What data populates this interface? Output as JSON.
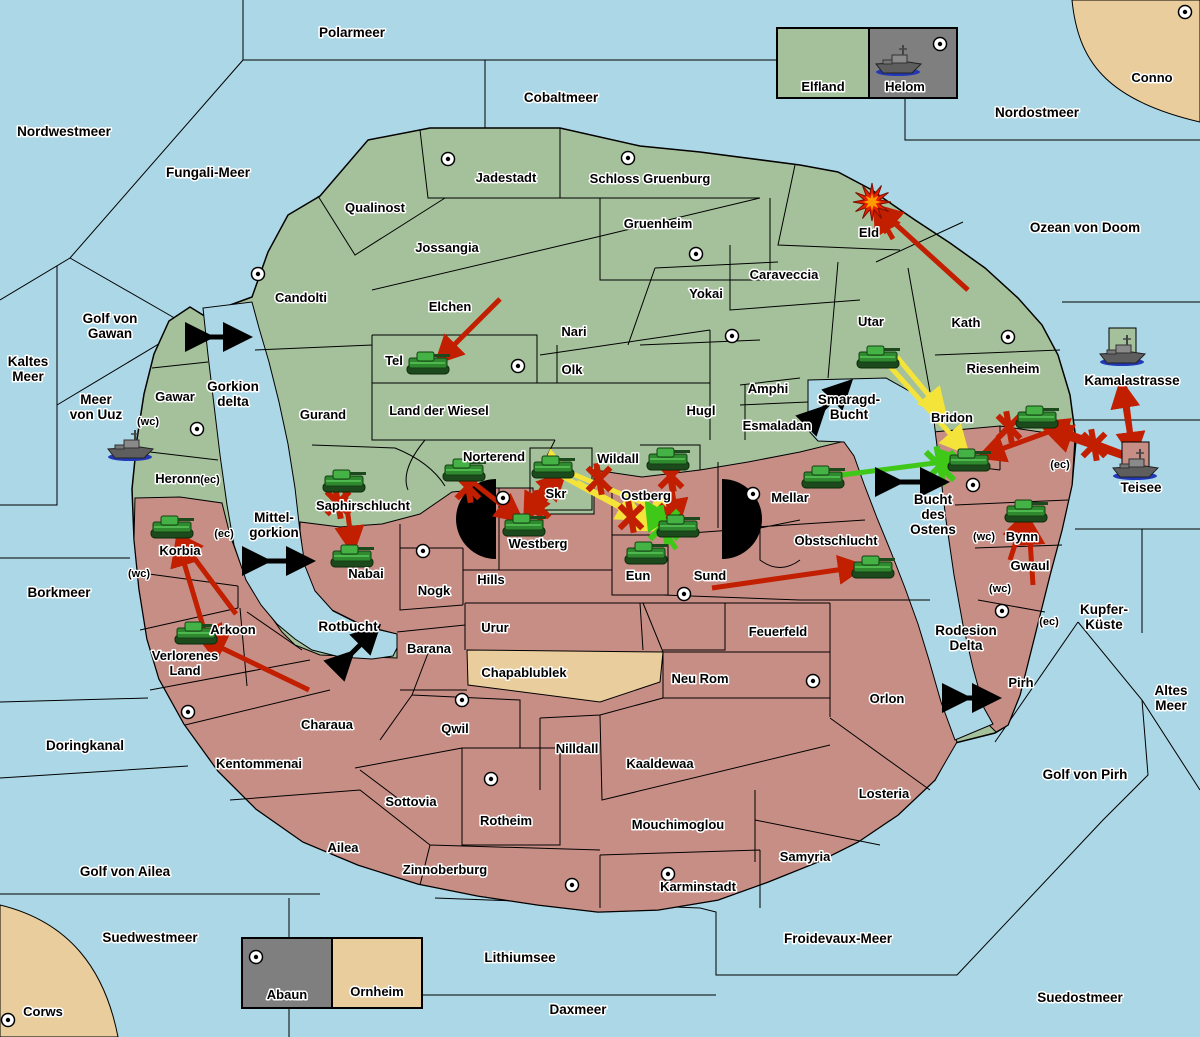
{
  "colors": {
    "sea": "#ABD7E6",
    "land_green": "#A5C19B",
    "land_red": "#C78E85",
    "land_tan": "#EACD9C",
    "legend_gray": "#7F7F7F",
    "border": "#000000",
    "arrow_red": "#C21E00",
    "arrow_yellow": "#F4E43A",
    "arrow_green": "#3FC818",
    "passage_black": "#000000",
    "halo": "#FFFFFF"
  },
  "legend_top": {
    "left": "Elfland",
    "right": "Helom"
  },
  "legend_bottom": {
    "left": "Abaun",
    "right": "Ornheim"
  },
  "sea_labels": [
    {
      "x": 352,
      "y": 37,
      "lines": [
        "Polarmeer"
      ]
    },
    {
      "x": 561,
      "y": 102,
      "lines": [
        "Cobaltmeer"
      ]
    },
    {
      "x": 1037,
      "y": 117,
      "lines": [
        "Nordostmeer"
      ]
    },
    {
      "x": 1085,
      "y": 232,
      "lines": [
        "Ozean von Doom"
      ]
    },
    {
      "x": 64,
      "y": 136,
      "lines": [
        "Nordwestmeer"
      ]
    },
    {
      "x": 208,
      "y": 177,
      "lines": [
        "Fungali-Meer"
      ]
    },
    {
      "x": 28,
      "y": 366,
      "lines": [
        "Kaltes",
        "Meer"
      ]
    },
    {
      "x": 110,
      "y": 323,
      "lines": [
        "Golf von",
        "Gawan"
      ]
    },
    {
      "x": 96,
      "y": 404,
      "lines": [
        "Meer",
        "von Uuz"
      ]
    },
    {
      "x": 233,
      "y": 391,
      "lines": [
        "Gorkion",
        "delta"
      ]
    },
    {
      "x": 274,
      "y": 522,
      "lines": [
        "Mittel-",
        "gorkion"
      ]
    },
    {
      "x": 59,
      "y": 597,
      "lines": [
        "Borkmeer"
      ]
    },
    {
      "x": 348,
      "y": 631,
      "lines": [
        "Rotbucht"
      ]
    },
    {
      "x": 849,
      "y": 404,
      "lines": [
        "Smaragd-",
        "Bucht"
      ]
    },
    {
      "x": 933,
      "y": 504,
      "lines": [
        "Bucht",
        "des",
        "Ostens"
      ]
    },
    {
      "x": 1132,
      "y": 385,
      "lines": [
        "Kamalastrasse"
      ]
    },
    {
      "x": 1141,
      "y": 492,
      "lines": [
        "Teisee"
      ]
    },
    {
      "x": 1104,
      "y": 614,
      "lines": [
        "Kupfer-",
        "Küste"
      ]
    },
    {
      "x": 1171,
      "y": 695,
      "lines": [
        "Altes",
        "Meer"
      ]
    },
    {
      "x": 1085,
      "y": 779,
      "lines": [
        "Golf von Pirh"
      ]
    },
    {
      "x": 966,
      "y": 635,
      "lines": [
        "Rodesion",
        "Delta"
      ]
    },
    {
      "x": 85,
      "y": 750,
      "lines": [
        "Doringkanal"
      ]
    },
    {
      "x": 125,
      "y": 876,
      "lines": [
        "Golf von Ailea"
      ]
    },
    {
      "x": 150,
      "y": 942,
      "lines": [
        "Suedwestmeer"
      ]
    },
    {
      "x": 520,
      "y": 962,
      "lines": [
        "Lithiumsee"
      ]
    },
    {
      "x": 578,
      "y": 1014,
      "lines": [
        "Daxmeer"
      ]
    },
    {
      "x": 838,
      "y": 943,
      "lines": [
        "Froidevaux-Meer"
      ]
    },
    {
      "x": 1080,
      "y": 1002,
      "lines": [
        "Suedostmeer"
      ]
    }
  ],
  "region_labels": [
    {
      "x": 506,
      "y": 182,
      "lines": [
        "Jadestadt"
      ]
    },
    {
      "x": 650,
      "y": 183,
      "lines": [
        "Schloss Gruenburg"
      ]
    },
    {
      "x": 375,
      "y": 212,
      "lines": [
        "Qualinost"
      ]
    },
    {
      "x": 447,
      "y": 252,
      "lines": [
        "Jossangia"
      ]
    },
    {
      "x": 658,
      "y": 228,
      "lines": [
        "Gruenheim"
      ]
    },
    {
      "x": 784,
      "y": 279,
      "lines": [
        "Caraveccia"
      ]
    },
    {
      "x": 706,
      "y": 298,
      "lines": [
        "Yokai"
      ]
    },
    {
      "x": 301,
      "y": 302,
      "lines": [
        "Candolti"
      ]
    },
    {
      "x": 450,
      "y": 311,
      "lines": [
        "Elchen"
      ]
    },
    {
      "x": 574,
      "y": 336,
      "lines": [
        "Nari"
      ]
    },
    {
      "x": 572,
      "y": 374,
      "lines": [
        "Olk"
      ]
    },
    {
      "x": 394,
      "y": 365,
      "lines": [
        "Tel"
      ]
    },
    {
      "x": 323,
      "y": 419,
      "lines": [
        "Gurand"
      ]
    },
    {
      "x": 439,
      "y": 415,
      "lines": [
        "Land der Wiesel"
      ]
    },
    {
      "x": 701,
      "y": 415,
      "lines": [
        "Hugl"
      ]
    },
    {
      "x": 768,
      "y": 393,
      "lines": [
        "Amphi"
      ]
    },
    {
      "x": 777,
      "y": 430,
      "lines": [
        "Esmaladan"
      ]
    },
    {
      "x": 869,
      "y": 237,
      "lines": [
        "Eld"
      ]
    },
    {
      "x": 871,
      "y": 326,
      "lines": [
        "Utar"
      ]
    },
    {
      "x": 966,
      "y": 327,
      "lines": [
        "Kath"
      ]
    },
    {
      "x": 1003,
      "y": 373,
      "lines": [
        "Riesenheim"
      ]
    },
    {
      "x": 494,
      "y": 461,
      "lines": [
        "Norterend"
      ]
    },
    {
      "x": 618,
      "y": 463,
      "lines": [
        "Wildall"
      ]
    },
    {
      "x": 556,
      "y": 498,
      "lines": [
        "Skr"
      ]
    },
    {
      "x": 646,
      "y": 500,
      "lines": [
        "Ostberg"
      ]
    },
    {
      "x": 175,
      "y": 401,
      "lines": [
        "Gawar"
      ]
    },
    {
      "x": 178,
      "y": 483,
      "lines": [
        "Heronn"
      ]
    },
    {
      "x": 363,
      "y": 510,
      "lines": [
        "Saphirschlucht"
      ]
    },
    {
      "x": 180,
      "y": 555,
      "lines": [
        "Korbia"
      ]
    },
    {
      "x": 233,
      "y": 634,
      "lines": [
        "Arkoon"
      ]
    },
    {
      "x": 185,
      "y": 660,
      "lines": [
        "Verlorenes",
        "Land"
      ]
    },
    {
      "x": 327,
      "y": 729,
      "lines": [
        "Charaua"
      ]
    },
    {
      "x": 259,
      "y": 768,
      "lines": [
        "Kentommenai"
      ]
    },
    {
      "x": 343,
      "y": 852,
      "lines": [
        "Ailea"
      ]
    },
    {
      "x": 445,
      "y": 874,
      "lines": [
        "Zinnoberburg"
      ]
    },
    {
      "x": 411,
      "y": 806,
      "lines": [
        "Sottovia"
      ]
    },
    {
      "x": 506,
      "y": 825,
      "lines": [
        "Rotheim"
      ]
    },
    {
      "x": 455,
      "y": 733,
      "lines": [
        "Qwil"
      ]
    },
    {
      "x": 366,
      "y": 578,
      "lines": [
        "Nabai"
      ]
    },
    {
      "x": 434,
      "y": 595,
      "lines": [
        "Nogk"
      ]
    },
    {
      "x": 491,
      "y": 584,
      "lines": [
        "Hills"
      ]
    },
    {
      "x": 538,
      "y": 548,
      "lines": [
        "Westberg"
      ]
    },
    {
      "x": 638,
      "y": 580,
      "lines": [
        "Eun"
      ]
    },
    {
      "x": 710,
      "y": 580,
      "lines": [
        "Sund"
      ]
    },
    {
      "x": 790,
      "y": 502,
      "lines": [
        "Mellar"
      ]
    },
    {
      "x": 836,
      "y": 545,
      "lines": [
        "Obstschlucht"
      ]
    },
    {
      "x": 495,
      "y": 632,
      "lines": [
        "Urur"
      ]
    },
    {
      "x": 429,
      "y": 653,
      "lines": [
        "Barana"
      ]
    },
    {
      "x": 524,
      "y": 677,
      "lines": [
        "Chapablublek"
      ]
    },
    {
      "x": 700,
      "y": 683,
      "lines": [
        "Neu Rom"
      ]
    },
    {
      "x": 778,
      "y": 636,
      "lines": [
        "Feuerfeld"
      ]
    },
    {
      "x": 577,
      "y": 753,
      "lines": [
        "Nilldall"
      ]
    },
    {
      "x": 660,
      "y": 768,
      "lines": [
        "Kaaldewaa"
      ]
    },
    {
      "x": 678,
      "y": 829,
      "lines": [
        "Mouchimoglou"
      ]
    },
    {
      "x": 887,
      "y": 703,
      "lines": [
        "Orlon"
      ]
    },
    {
      "x": 884,
      "y": 798,
      "lines": [
        "Losteria"
      ]
    },
    {
      "x": 805,
      "y": 861,
      "lines": [
        "Samyria"
      ]
    },
    {
      "x": 698,
      "y": 891,
      "lines": [
        "Karminstadt"
      ]
    },
    {
      "x": 952,
      "y": 422,
      "lines": [
        "Bridon"
      ]
    },
    {
      "x": 1022,
      "y": 541,
      "lines": [
        "Bynn"
      ]
    },
    {
      "x": 1030,
      "y": 570,
      "lines": [
        "Gwaul"
      ]
    },
    {
      "x": 1021,
      "y": 687,
      "lines": [
        "Pirh"
      ]
    },
    {
      "x": 1152,
      "y": 82,
      "lines": [
        "Conno"
      ]
    },
    {
      "x": 43,
      "y": 1016,
      "lines": [
        "Corws"
      ]
    }
  ],
  "status_labels": [
    {
      "x": 148,
      "y": 425,
      "t": "(wc)"
    },
    {
      "x": 210,
      "y": 483,
      "t": "(ec)"
    },
    {
      "x": 224,
      "y": 537,
      "t": "(ec)"
    },
    {
      "x": 139,
      "y": 577,
      "t": "(wc)"
    },
    {
      "x": 1060,
      "y": 468,
      "t": "(ec)"
    },
    {
      "x": 984,
      "y": 540,
      "t": "(wc)"
    },
    {
      "x": 1000,
      "y": 592,
      "t": "(wc)"
    },
    {
      "x": 1049,
      "y": 625,
      "t": "(ec)"
    }
  ],
  "cities": [
    [
      448,
      159
    ],
    [
      628,
      158
    ],
    [
      696,
      254
    ],
    [
      732,
      336
    ],
    [
      258,
      274
    ],
    [
      518,
      366
    ],
    [
      1008,
      337
    ],
    [
      197,
      429
    ],
    [
      503,
      498
    ],
    [
      423,
      551
    ],
    [
      753,
      494
    ],
    [
      684,
      594
    ],
    [
      973,
      485
    ],
    [
      188,
      712
    ],
    [
      462,
      700
    ],
    [
      491,
      779
    ],
    [
      572,
      885
    ],
    [
      813,
      681
    ],
    [
      668,
      874
    ],
    [
      1002,
      611
    ],
    [
      1185,
      12
    ],
    [
      8,
      1020
    ],
    [
      940,
      44
    ],
    [
      256,
      957
    ]
  ],
  "tanks": [
    [
      428,
      363
    ],
    [
      878,
      357
    ],
    [
      1037,
      417
    ],
    [
      969,
      460
    ],
    [
      823,
      477
    ],
    [
      873,
      567
    ],
    [
      1026,
      511
    ],
    [
      464,
      470
    ],
    [
      553,
      467
    ],
    [
      668,
      459
    ],
    [
      524,
      525
    ],
    [
      646,
      553
    ],
    [
      678,
      526
    ],
    [
      344,
      481
    ],
    [
      352,
      556
    ],
    [
      172,
      527
    ],
    [
      196,
      633
    ]
  ],
  "ships": [
    {
      "x": 130,
      "y": 447,
      "box": ""
    },
    {
      "x": 898,
      "y": 62,
      "box": ""
    },
    {
      "x": 1122,
      "y": 352,
      "box": "#A5C19B"
    },
    {
      "x": 1135,
      "y": 466,
      "box": "#C78E85"
    }
  ],
  "explosions": [
    [
      872,
      202
    ]
  ],
  "attack_arrows": [
    {
      "c": "red",
      "pts": [
        968,
        290,
        880,
        210
      ]
    },
    {
      "c": "red",
      "pts": [
        893,
        239,
        878,
        213
      ]
    },
    {
      "c": "red",
      "pts": [
        500,
        299,
        441,
        358
      ]
    },
    {
      "c": "red",
      "pts": [
        236,
        614,
        180,
        539
      ]
    },
    {
      "c": "red",
      "pts": [
        212,
        656,
        179,
        546
      ]
    },
    {
      "c": "red",
      "pts": [
        309,
        690,
        205,
        640
      ]
    },
    {
      "c": "red",
      "pts": [
        222,
        637,
        202,
        637
      ]
    },
    {
      "c": "red",
      "pts": [
        712,
        588,
        858,
        567
      ]
    },
    {
      "c": "red",
      "pts": [
        345,
        492,
        352,
        546
      ]
    },
    {
      "c": "red",
      "pts": [
        470,
        480,
        517,
        517
      ]
    },
    {
      "c": "red",
      "pts": [
        545,
        483,
        528,
        514
      ]
    },
    {
      "c": "red",
      "pts": [
        530,
        508,
        560,
        478
      ]
    },
    {
      "c": "red",
      "pts": [
        668,
        467,
        677,
        519
      ]
    },
    {
      "c": "red",
      "pts": [
        1010,
        560,
        1023,
        520
      ]
    },
    {
      "c": "red",
      "pts": [
        1033,
        585,
        1029,
        525
      ]
    },
    {
      "c": "red",
      "pts": [
        1135,
        458,
        1048,
        425
      ]
    },
    {
      "c": "red",
      "pts": [
        1138,
        462,
        1052,
        432
      ]
    },
    {
      "c": "red",
      "pts": [
        1070,
        424,
        985,
        455
      ]
    },
    {
      "c": "red",
      "pts": [
        1133,
        455,
        1122,
        388
      ]
    },
    {
      "c": "red",
      "pts": [
        1124,
        380,
        1133,
        452
      ]
    },
    {
      "c": "yellow",
      "pts": [
        886,
        362,
        963,
        448
      ]
    },
    {
      "c": "yellow",
      "pts": [
        897,
        357,
        941,
        410
      ]
    },
    {
      "c": "yellow",
      "pts": [
        563,
        470,
        670,
        514
      ],
      "both": true
    },
    {
      "c": "yellow",
      "pts": [
        560,
        475,
        656,
        527
      ]
    },
    {
      "c": "yellow",
      "pts": [
        577,
        482,
        638,
        516
      ]
    },
    {
      "c": "green",
      "pts": [
        826,
        477,
        958,
        460
      ]
    },
    {
      "c": "green",
      "pts": [
        676,
        549,
        650,
        508
      ]
    }
  ],
  "blocked_marks": [
    {
      "c": "red",
      "x": 468,
      "y": 487
    },
    {
      "c": "red",
      "x": 538,
      "y": 506
    },
    {
      "c": "red",
      "x": 599,
      "y": 479
    },
    {
      "c": "red",
      "x": 631,
      "y": 517
    },
    {
      "c": "red",
      "x": 671,
      "y": 476
    },
    {
      "c": "red",
      "x": 671,
      "y": 516
    },
    {
      "c": "red",
      "x": 338,
      "y": 503
    },
    {
      "c": "red",
      "x": 1094,
      "y": 445
    },
    {
      "c": "red",
      "x": 1009,
      "y": 427
    },
    {
      "c": "green",
      "x": 940,
      "y": 466
    },
    {
      "c": "green",
      "x": 664,
      "y": 525
    }
  ],
  "passage_arrows": [
    [
      205,
      337,
      243,
      337
    ],
    [
      262,
      561,
      306,
      561
    ],
    [
      348,
      657,
      374,
      631
    ],
    [
      820,
      412,
      846,
      386
    ],
    [
      895,
      482,
      940,
      482
    ],
    [
      962,
      698,
      992,
      698
    ]
  ]
}
